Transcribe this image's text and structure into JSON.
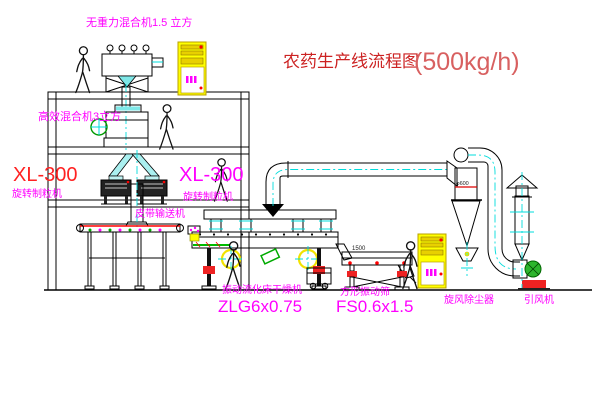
{
  "diagram": {
    "title": {
      "text": "农药生产线流程图",
      "capacity": "(500kg/h)"
    },
    "labels": {
      "gravity_free_mixer": "无重力混合机1.5 立方",
      "high_efficiency_mixer": "高效混合机3立方",
      "granulator_left_model": "XL-300",
      "granulator_left_name": "旋转制粒机",
      "granulator_center_model": "XL-300",
      "granulator_center_name": "旋转制粒机",
      "belt_conveyor": "皮带输送机",
      "fluid_bed_dryer_name": "振动流化床干燥机",
      "fluid_bed_dryer_model": "ZLG6x0.75",
      "vibrating_sieve_name": "方形振动筛",
      "vibrating_sieve_model": "FS0.6x1.5",
      "cyclone_dust_collector": "旋风除尘器",
      "induced_draft_fan": "引风机"
    },
    "dimensions": {
      "sieve_length": "1500",
      "cyclone_diameter": "φ600"
    },
    "colors": {
      "label_magenta": "#ff00ff",
      "title_red": "#cc2222",
      "capacity_red": "#d86060",
      "model_red": "#ff2222",
      "line_black": "#000000",
      "centerline_cyan": "#00dcdc",
      "cabinet_yellow": "#ffff00",
      "accent_red": "#ff0000",
      "motor_green": "#2db52d"
    }
  }
}
